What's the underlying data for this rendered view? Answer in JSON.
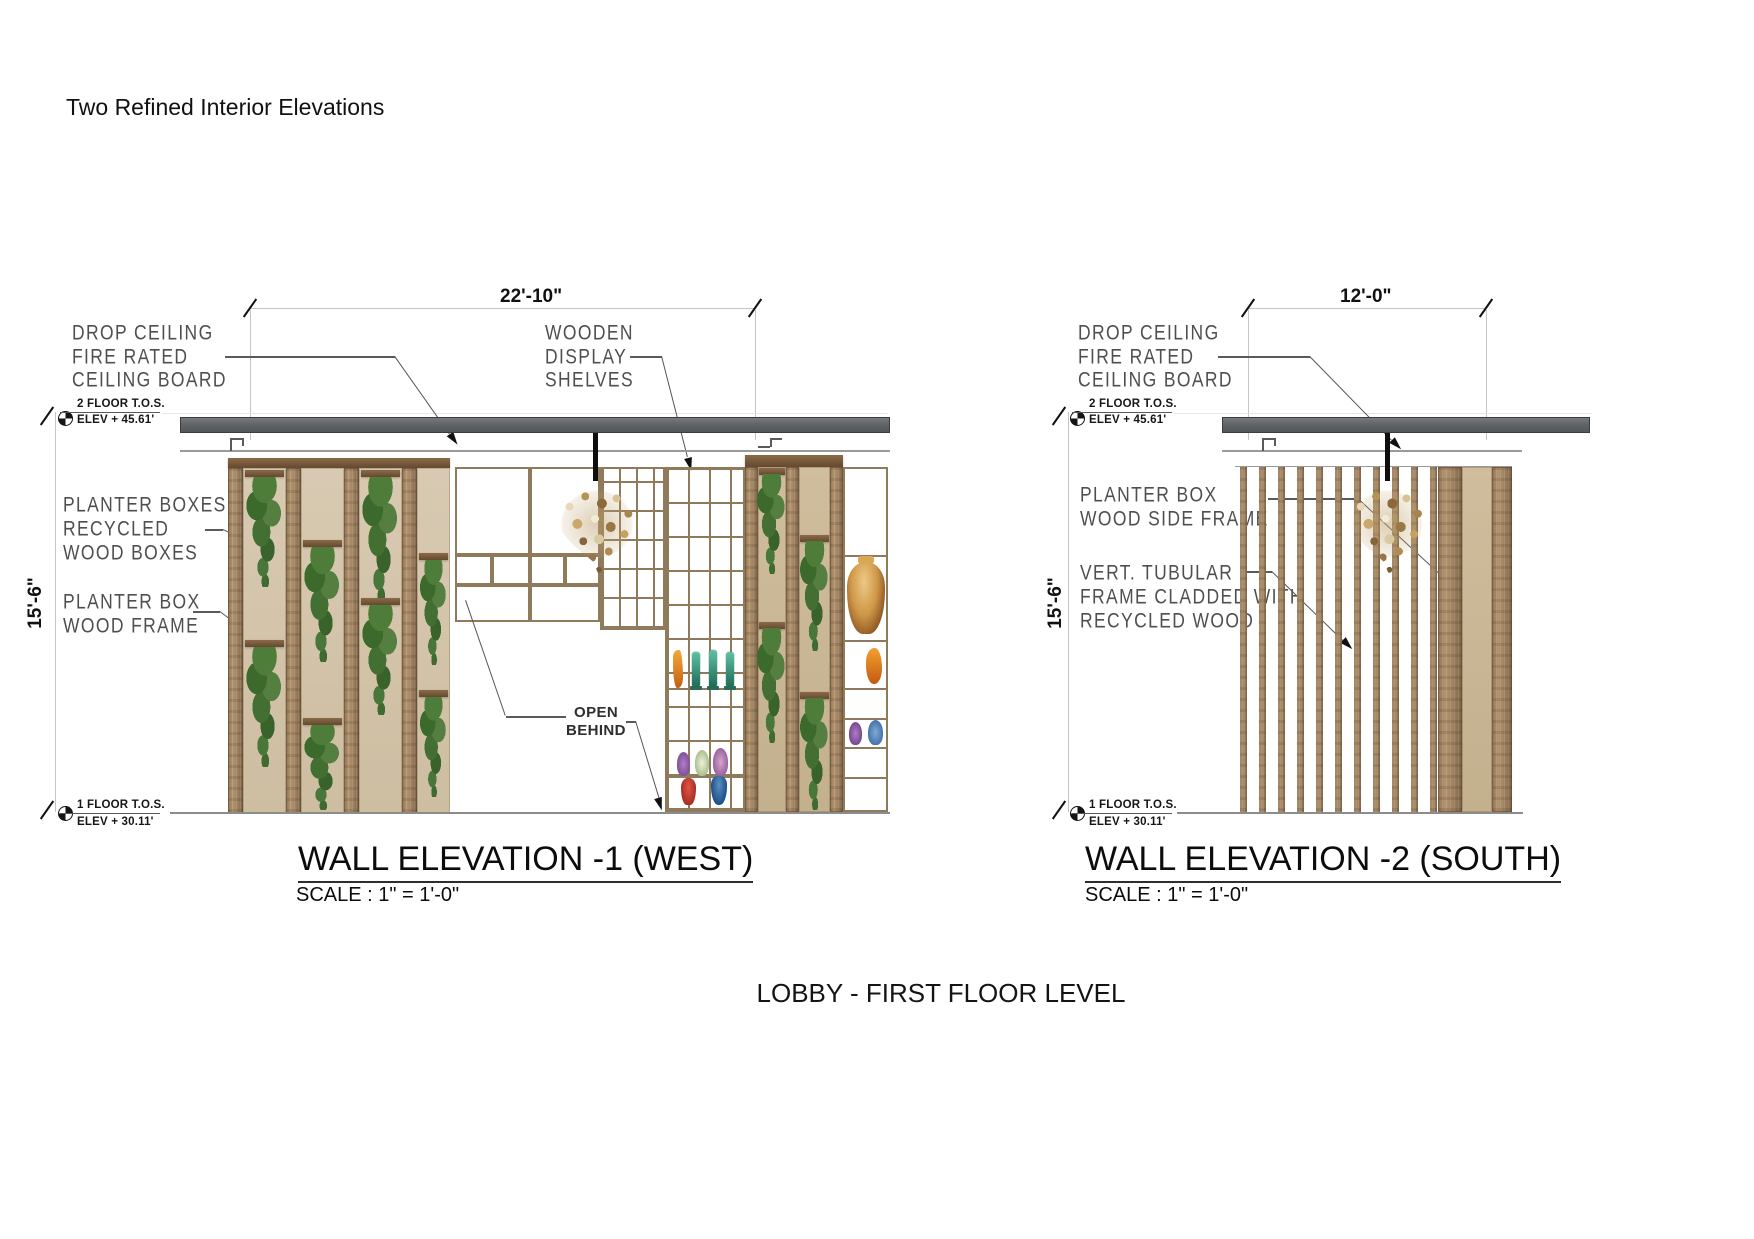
{
  "page": {
    "title": "Two Refined Interior Elevations",
    "caption": "LOBBY - FIRST FLOOR LEVEL"
  },
  "colors": {
    "beam_gray": "#626568",
    "wood_strip": "#a08462",
    "panel_cream": "#d2c3a8",
    "ivy_green": "#4e7d3a",
    "label_gray": "#4f4f4f",
    "chandelier_gold": "#caa86b"
  },
  "elev_west": {
    "title": "WALL ELEVATION -1 (WEST)",
    "scale": "SCALE : 1\" = 1'-0\"",
    "width_dim": "22'-10\"",
    "height_dim": "15'-6\"",
    "marker_top": {
      "line1": "2 FLOOR T.O.S.",
      "line2": "ELEV + 45.61'"
    },
    "marker_bottom": {
      "line1": "1 FLOOR T.O.S.",
      "line2": "ELEV + 30.11'"
    },
    "labels": {
      "drop_ceiling": [
        "DROP CEILING",
        "FIRE RATED",
        "CEILING BOARD"
      ],
      "planter_boxes": [
        "PLANTER BOXES",
        "RECYCLED",
        "WOOD BOXES"
      ],
      "planter_frame": [
        "PLANTER BOX",
        "WOOD FRAME"
      ],
      "display_shelves": [
        "WOODEN",
        "DISPLAY",
        "SHELVES"
      ],
      "open_behind": [
        "OPEN",
        "BEHIND"
      ]
    }
  },
  "elev_south": {
    "title": "WALL ELEVATION -2  (SOUTH)",
    "scale": "SCALE : 1\" = 1'-0\"",
    "width_dim": "12'-0\"",
    "height_dim": "15'-6\"",
    "marker_top": {
      "line1": "2 FLOOR T.O.S.",
      "line2": "ELEV + 45.61'"
    },
    "marker_bottom": {
      "line1": "1 FLOOR T.O.S.",
      "line2": "ELEV + 30.11'"
    },
    "labels": {
      "drop_ceiling": [
        "DROP CEILING",
        "FIRE RATED",
        "CEILING BOARD"
      ],
      "side_frame": [
        "PLANTER BOX",
        "WOOD SIDE FRAME"
      ],
      "vert_tubular": [
        "VERT. TUBULAR",
        "FRAME CLADDED WITH",
        "RECYCLED WOOD"
      ]
    }
  }
}
